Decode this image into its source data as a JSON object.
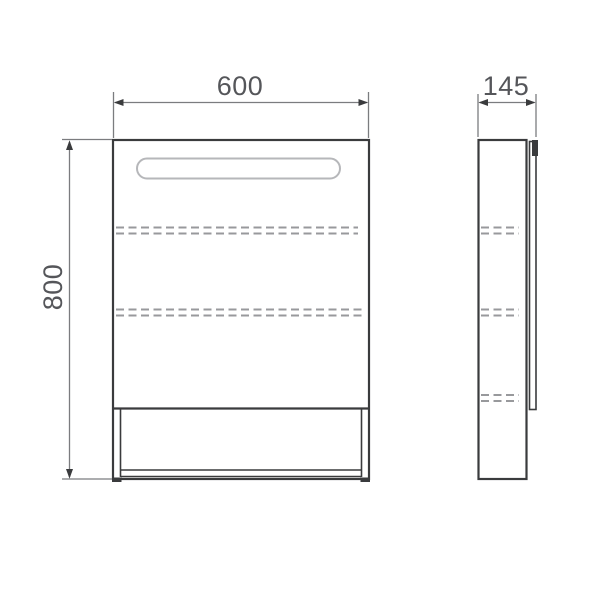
{
  "drawing": {
    "front_view": {
      "width_dim": "600",
      "height_dim": "800"
    },
    "side_view": {
      "depth_dim": "145"
    }
  },
  "colors": {
    "background": "#ffffff",
    "outline": "#3a3b3d",
    "dimension_line": "#7b7c7f",
    "hidden_line": "#98999c",
    "light_strip_outline": "#b6b7ba",
    "label_text": "#55565a"
  }
}
